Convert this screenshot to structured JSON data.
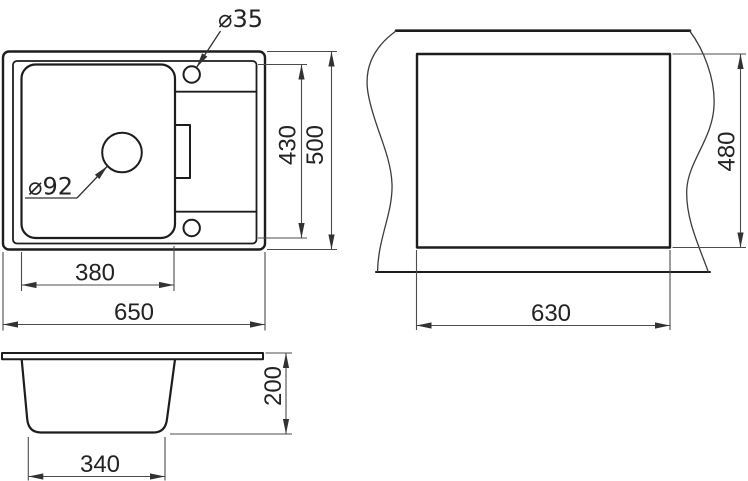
{
  "drawing": {
    "kind": "sink-technical-drawing",
    "colors": {
      "background": "#ffffff",
      "object_line": "#1d1d1d",
      "dimension_line": "#4c4c4c",
      "text": "#232323"
    },
    "top_view": {
      "overall_width": "650",
      "overall_depth": "500",
      "bowl_width": "380",
      "inner_depth": "430",
      "faucet_hole_diameter": "⌀35",
      "drain_hole_diameter": "⌀92"
    },
    "cutout_view": {
      "cutout_width": "630",
      "cutout_depth": "480"
    },
    "side_view": {
      "bowl_bottom_width": "340",
      "bowl_height": "200"
    }
  }
}
